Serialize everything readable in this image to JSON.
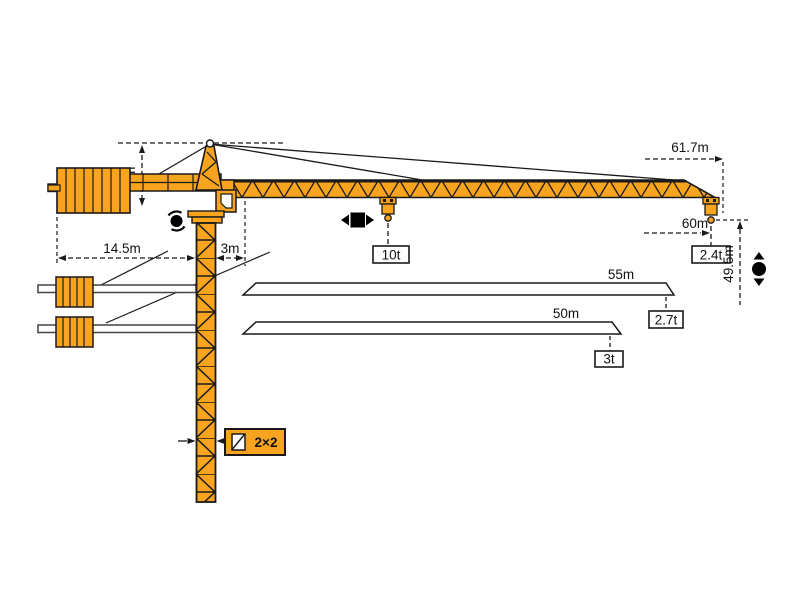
{
  "crane": {
    "description": "tower crane specification diagram",
    "dims": {
      "head_height": "7m",
      "counter_radius": "14.5m",
      "root_offset": "3m",
      "max_radius": "61.7m",
      "hook_radius": "60m",
      "hook_height": "49.5m",
      "mast_section": "2×2"
    },
    "loads": {
      "max_capacity": "10t",
      "tip_capacity": "2.4t"
    },
    "jib_variants": [
      {
        "length": "55m",
        "tip_capacity": "2.7t"
      },
      {
        "length": "50m",
        "tip_capacity": "3t"
      }
    ],
    "icons": {
      "slew": "rotation-icon",
      "trolley": "left-right-travel-icon",
      "hoist": "up-down-hoist-icon",
      "mast_section": "mast-cross-section-icon"
    },
    "colors": {
      "crane_orange": "#F8A41F",
      "outline": "#1A1A1A",
      "background": "#FFFFFF",
      "callout_fill": "#FFFFFF"
    }
  }
}
